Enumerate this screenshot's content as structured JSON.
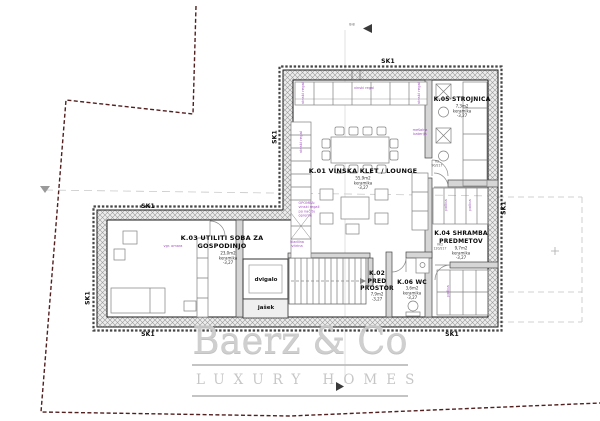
{
  "watermark": {
    "brand": "Baerz & Co",
    "tagline": "LUXURY HOMES"
  },
  "wall_tag": "SK1",
  "section_mark": "B-B",
  "rooms": {
    "k01": {
      "name": "K.01 VINSKA KLET / LOUNGE",
      "area": "55,9m2",
      "floor": "keramika",
      "level": "-3,27"
    },
    "k02": {
      "line1": "K.02",
      "line2": "PRED",
      "line3": "PROSTOR",
      "area": "7,9m2",
      "floor": "keramika",
      "level": "-3,27"
    },
    "k03": {
      "line1": "K.03 UTILITI SOBA ZA",
      "line2": "GOSPODINJO",
      "area": "23,0m2",
      "floor": "keramika",
      "level": "-3,27"
    },
    "k04": {
      "line1": "K.04 SHRAMBA",
      "line2": "PREDMETOV",
      "area": "9,7m2",
      "floor": "keramika",
      "level": "-3,27"
    },
    "k05": {
      "name": "K.05 STROJNICA",
      "area": "7,3m2",
      "floor": "keramika",
      "level": "-3,27"
    },
    "k06": {
      "name": "K.06 WC",
      "area": "3,6m2",
      "floor": "keramika",
      "level": "-3,27"
    }
  },
  "core": {
    "elevator": "dvigalo",
    "shaft": "jašek"
  },
  "annotations": {
    "wine_rack": "vinski regal",
    "shelf": "polica",
    "cooler_line1": "hladilna",
    "cooler_line2": "vitrina",
    "mixer_line1": "mešalna",
    "mixer_line2": "baterija",
    "wardrobe": "vgr. omara",
    "note_line1": "OPOMBA:",
    "note_line2": "vinski regali",
    "note_line3": "po načrtu",
    "note_line4": "opreme",
    "door1_line1": "V2",
    "door1_line2": "90/217",
    "door2_line1": "VK2",
    "door2_line2": "120/217"
  },
  "colors": {
    "boundary": "#521f1f",
    "annotation": "#a050c0",
    "watermark": "#c8c8c8",
    "wall_line": "#1a1a1a"
  }
}
